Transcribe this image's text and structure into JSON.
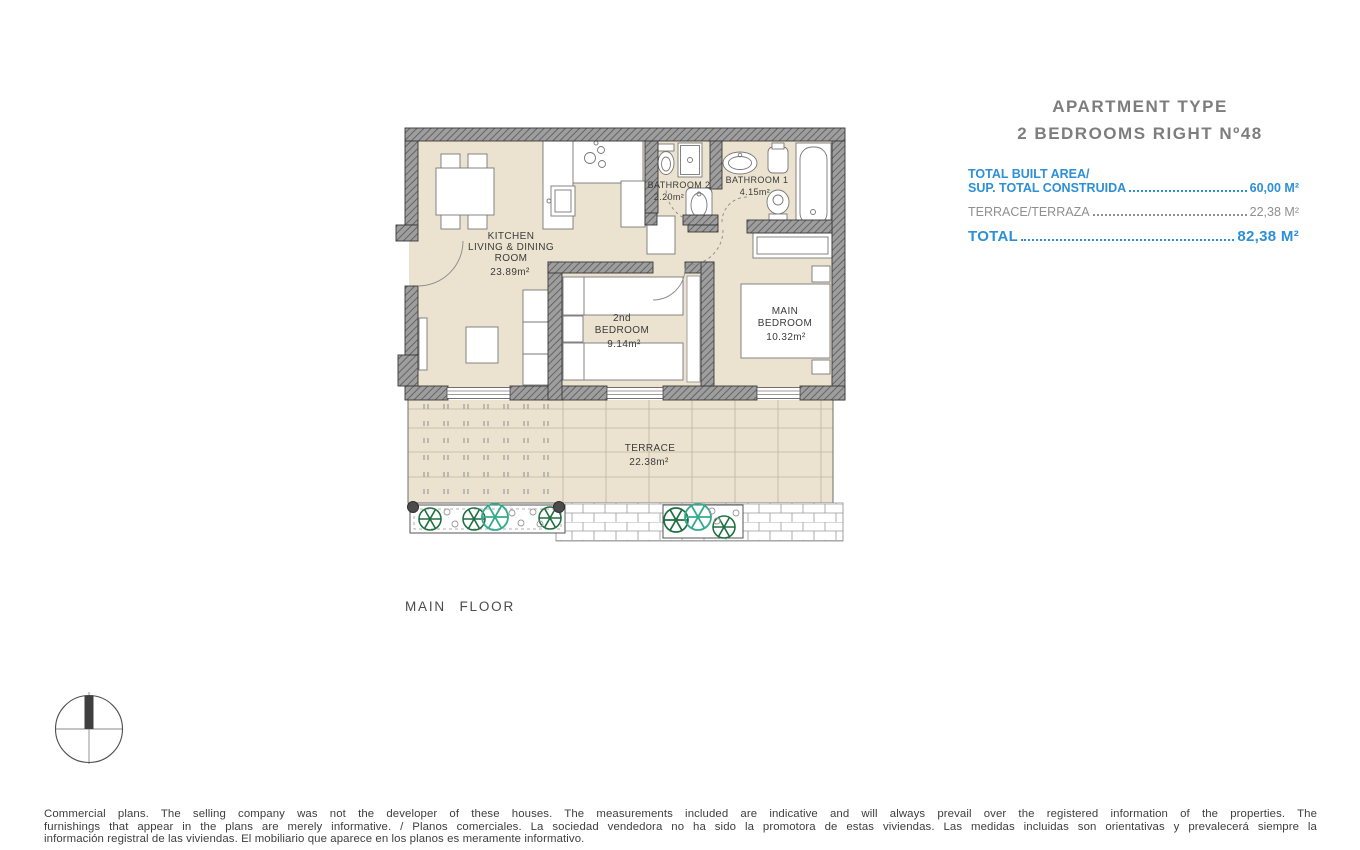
{
  "header": {
    "title_line1": "APARTMENT TYPE",
    "title_line2": "2 BEDROOMS RIGHT Nº48"
  },
  "area_table": {
    "built_label_en": "TOTAL BUILT AREA/",
    "built_label_es": "SUP. TOTAL CONSTRUIDA",
    "built_value": "60,00 M²",
    "terrace_label": "TERRACE/TERRAZA",
    "terrace_value": "22,38 M²",
    "total_label": "TOTAL",
    "total_value": "82,38 M²"
  },
  "plan": {
    "kitchen_line1": "KITCHEN",
    "kitchen_line2": "LIVING & DINING",
    "kitchen_line3": "ROOM",
    "kitchen_area": "23.89m²",
    "bathroom2_name": "BATHROOM 2",
    "bathroom2_area": "2.20m²",
    "bathroom1_name": "BATHROOM 1",
    "bathroom1_area": "4.15m²",
    "bedroom2_line1": "2nd",
    "bedroom2_line2": "BEDROOM",
    "bedroom2_area": "9.14m²",
    "main_bedroom_line1": "MAIN",
    "main_bedroom_line2": "BEDROOM",
    "main_bedroom_area": "10.32m²",
    "terrace_name": "TERRACE",
    "terrace_area": "22.38m²"
  },
  "floor_label": "MAIN FLOOR",
  "disclaimer": {
    "line1": "Commercial plans. The selling company was not the developer of these houses. The measurements included are indicative and will always prevail over the registered information of the properties. The",
    "line2": "furnishings that appear in the plans are merely informative. / Planos comerciales. La sociedad vendedora no ha sido la promotora de estas viviendas. Las medidas incluidas son orientativas y prevalecerá siempre la",
    "line3": "información registral de las viviendas. El mobiliario que aparece en los planos es meramente informativo."
  },
  "colors": {
    "accent_blue": "#2d8fd5",
    "muted_gray": "#8f8f8f",
    "floor_beige": "#ebe3d0",
    "wall_gray": "#9e9e9e",
    "plant_green": "#1e6e41",
    "plant_teal": "#35ab8c"
  }
}
